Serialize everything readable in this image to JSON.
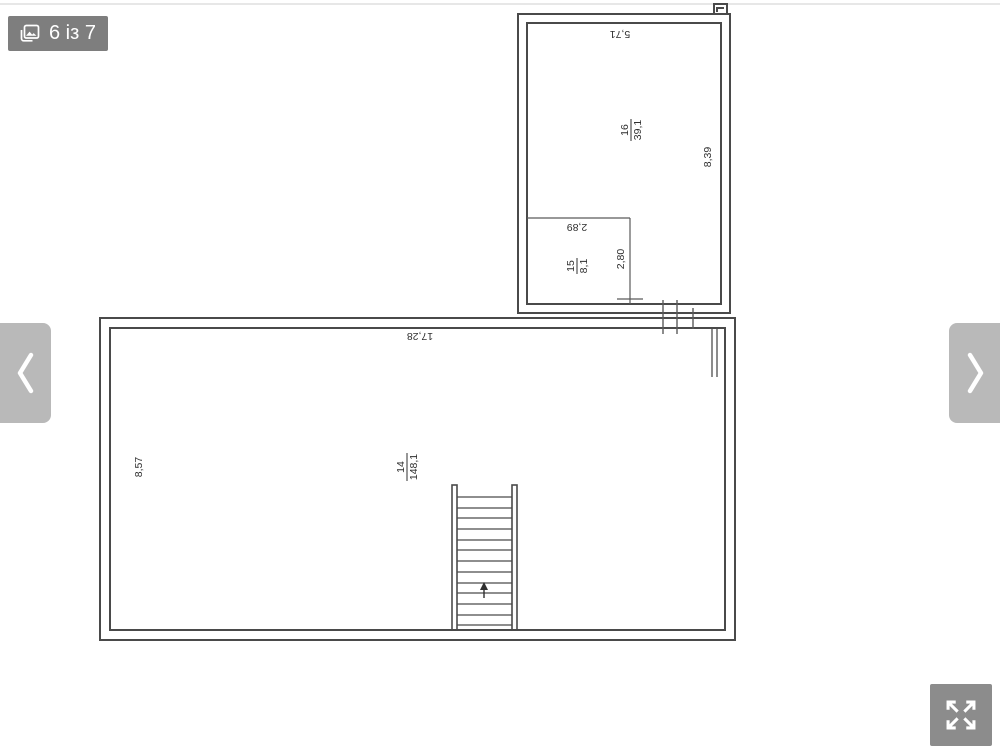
{
  "gallery": {
    "counter": "6 із 7",
    "icons": {
      "counter": "gallery-image-icon",
      "prev": "chevron-left",
      "next": "chevron-right",
      "fullscreen": "expand-arrows"
    },
    "colors": {
      "badge_bg": "#7e7e7e",
      "nav_bg": "#b9b9b9",
      "fullscreen_bg": "#8c8c8c",
      "icon_color": "#ffffff"
    }
  },
  "floor_plan": {
    "type": "architectural floor plan",
    "line_color": "#4a4a4a",
    "text_color": "#2f2f2f",
    "rooms": [
      {
        "number": "16",
        "area": "39,1"
      },
      {
        "number": "15",
        "area": "8,1"
      },
      {
        "number": "14",
        "area": "148,1"
      }
    ],
    "dimensions": {
      "room16_width": "5,71",
      "room16_height": "8,39",
      "room15_width": "2,89",
      "room15_height": "2,80",
      "room14_width": "17,28",
      "room14_height": "8,57"
    }
  }
}
